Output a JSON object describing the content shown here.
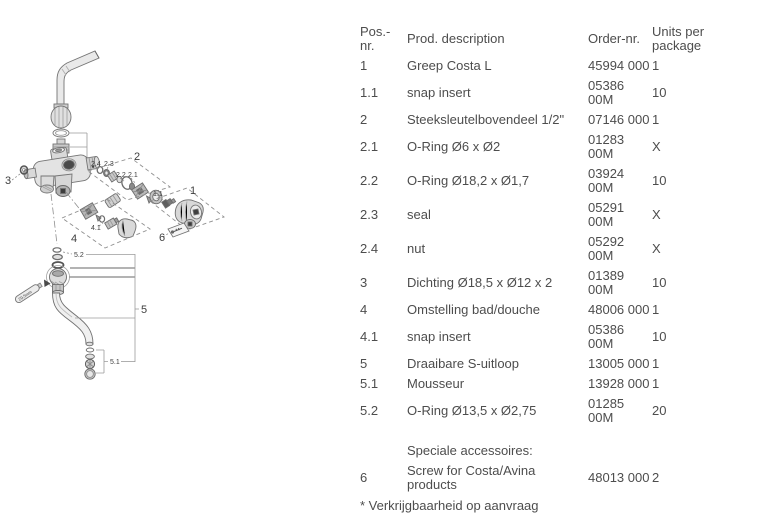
{
  "table": {
    "headers": {
      "pos": "Pos.-nr.",
      "desc": "Prod. description",
      "order": "Order-nr.",
      "units": "Units per package"
    },
    "rows": [
      {
        "pos": "1",
        "desc": "Greep Costa L",
        "order": "45994 000",
        "units": "1"
      },
      {
        "pos": "1.1",
        "desc": "snap insert",
        "order": "05386 00M",
        "units": "10"
      },
      {
        "pos": "2",
        "desc": "Steeksleutelbovendeel 1/2\"",
        "order": "07146 000",
        "units": "1"
      },
      {
        "pos": "2.1",
        "desc": "O-Ring Ø6 x Ø2",
        "order": "01283 00M",
        "units": "X"
      },
      {
        "pos": "2.2",
        "desc": "O-Ring Ø18,2 x Ø1,7",
        "order": "03924 00M",
        "units": "10"
      },
      {
        "pos": "2.3",
        "desc": "seal",
        "order": "05291 00M",
        "units": "X"
      },
      {
        "pos": "2.4",
        "desc": "nut",
        "order": "05292 00M",
        "units": "X"
      },
      {
        "pos": "3",
        "desc": "Dichting Ø18,5 x Ø12 x 2",
        "order": "01389 00M",
        "units": "10"
      },
      {
        "pos": "4",
        "desc": "Omstelling bad/douche",
        "order": "48006 000",
        "units": "1"
      },
      {
        "pos": "4.1",
        "desc": "snap insert",
        "order": "05386 00M",
        "units": "10"
      },
      {
        "pos": "5",
        "desc": "Draaibare S-uitloop",
        "order": "13005 000",
        "units": "1"
      },
      {
        "pos": "5.1",
        "desc": "Mousseur",
        "order": "13928 000",
        "units": "1"
      },
      {
        "pos": "5.2",
        "desc": "O-Ring Ø13,5 x Ø2,75",
        "order": "01285 00M",
        "units": "20"
      },
      {
        "pos": "",
        "desc": "Speciale accessoires:",
        "order": "",
        "units": ""
      },
      {
        "pos": "6",
        "desc": "Screw for Costa/Avina products",
        "order": "48013 000",
        "units": "2"
      }
    ],
    "footnote": "* Verkrijgbaarheid op aanvraag"
  },
  "diagram": {
    "callouts": {
      "c1": "1",
      "c11": "1.1",
      "c2": "2",
      "c21": "2.1",
      "c22": "2.2",
      "c23": "2.3",
      "c24": "2.4",
      "c3": "3",
      "c4": "4",
      "c41": "4.1",
      "c5": "5",
      "c51": "5.1",
      "c52": "5.2",
      "c6": "6",
      "tool": "29,5mm"
    },
    "colors": {
      "line": "#757575",
      "label": "#3e3e3e"
    }
  }
}
